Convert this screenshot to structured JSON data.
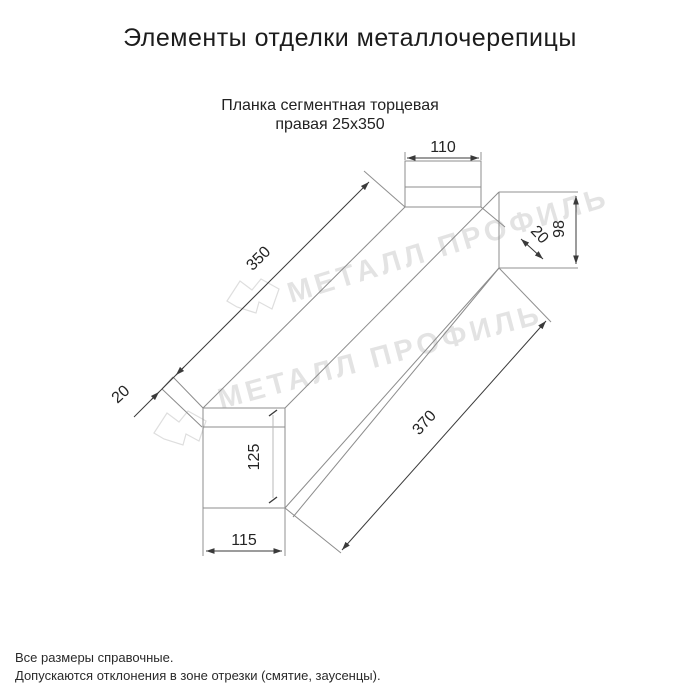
{
  "page": {
    "title": "Элементы отделки металлочерепицы",
    "subtitle_line1": "Планка сегментная торцевая",
    "subtitle_line2": "правая 25х350"
  },
  "watermark": {
    "brand": "МЕТАЛЛ ПРОФИЛЬ"
  },
  "dims": {
    "flange_width_top": "110",
    "web_height_right": "98",
    "hem_right": "20",
    "edge_length_upper": "350",
    "edge_length_lower": "370",
    "hem_left": "20",
    "web_height_left": "125",
    "bottom_width_left": "115"
  },
  "footer": {
    "line1": "Все размеры справочные.",
    "line2": "Допускаются отклонения в зоне отрезки (смятие, заусенцы)."
  },
  "colors": {
    "structure_line": "#8c8c8c",
    "dimension_line": "#3a3a3a",
    "text": "#1c1c1c",
    "watermark": "rgba(0,0,0,0.11)"
  }
}
